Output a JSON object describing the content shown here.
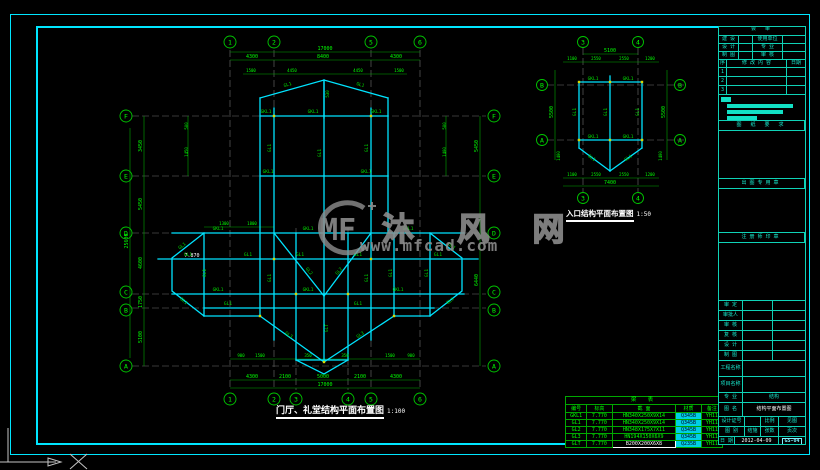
{
  "watermark": {
    "logo_text": "MF",
    "brand": "沐 风 网",
    "url": "www.mfcad.com"
  },
  "main_plan": {
    "title": "门厅、礼堂结构平面布置图",
    "scale": "1:100",
    "axes_top": [
      "1",
      "2",
      "5",
      "6"
    ],
    "axes_bottom": [
      "1",
      "2",
      "3",
      "4",
      "5",
      "6"
    ],
    "axes_left": [
      "F",
      "E",
      "D",
      "C",
      "B",
      "A"
    ],
    "axes_right": [
      "F",
      "E",
      "D",
      "C",
      "B",
      "A"
    ],
    "dim_total": "17000",
    "dims_top": [
      "4300",
      "8400",
      "4300"
    ],
    "dims_top_inner": [
      "1500",
      "4450",
      "4450",
      "1500"
    ],
    "dims_bottom": [
      "4300",
      "2100",
      "5000",
      "2100",
      "4300"
    ],
    "dims_bottom_small": [
      "900",
      "1500",
      "350",
      "350",
      "1500",
      "900"
    ],
    "dims_left": [
      "3450",
      "5450",
      "4600",
      "1750",
      "5100"
    ],
    "dim_left_total": "25600",
    "dims_right": [
      "5450",
      "6440"
    ],
    "dims_misc": [
      "500",
      "1450",
      "1400",
      "500",
      "1300",
      "1800"
    ],
    "level_label": "7.870",
    "ridge_dim": "530"
  },
  "entry_plan": {
    "title": "入口结构平面布置图",
    "scale": "1:50",
    "axes_top": [
      "3",
      "4"
    ],
    "axes_bottom": [
      "3",
      "4"
    ],
    "axes_left": [
      "B",
      "A"
    ],
    "axes_right": [
      "B",
      "A"
    ],
    "dim_top_total": "5100",
    "dims_top": [
      "1100",
      "2550",
      "2550",
      "1200"
    ],
    "dims_bottom": [
      "1100",
      "2550",
      "2550",
      "1200"
    ],
    "dim_bottom_total": "7400",
    "dims_side": [
      "5500",
      "5500"
    ],
    "dims_side_small": [
      "1400",
      "1400"
    ]
  },
  "beam_names": {
    "gkl1": "GKL1",
    "gl1": "GL1",
    "gl2": "GL2",
    "gl3": "GL3",
    "glt": "GLT"
  },
  "beam_table": {
    "title": "梁 表",
    "headers": [
      "编号",
      "标高",
      "截  面",
      "材质",
      "备注"
    ],
    "rows": [
      [
        "GKL1",
        "7.770",
        "HN340X250X9X14",
        "Q345B",
        "YH11"
      ],
      [
        "GL1",
        "7.770",
        "HN340X250X9X14",
        "Q345B",
        "YH11"
      ],
      [
        "GL2",
        "7.770",
        "HN348X175X7X11",
        "Q345B",
        "YH11"
      ],
      [
        "GL3",
        "7.770",
        "HN194X150X6X9",
        "Q345B",
        "YH11"
      ],
      [
        "GLT",
        "7.770",
        "B200X200X6X8",
        "Q235B",
        "YH11"
      ]
    ]
  },
  "titleblock": {
    "review_header": "会  审",
    "row1": [
      "建 设",
      "使用单位"
    ],
    "row2": [
      "设 计",
      "专 业"
    ],
    "row3": [
      "制 图",
      "审 核"
    ],
    "rev_cols": [
      "序",
      "修 改 内 容",
      "日期"
    ],
    "rev_rows": [
      "1",
      "2",
      "3"
    ],
    "sections": [
      "图 纸 要 求",
      "出图专用章",
      "注册师印章"
    ],
    "info_labels": [
      "审 定",
      "审批人",
      "审 核",
      "复 核",
      "设 计",
      "制 图"
    ],
    "project_labels": [
      "工程名称",
      "项目名称"
    ],
    "spec_label": "专 业",
    "spec_value": "结构",
    "name_label": "图 名",
    "name_value": "结构平面布置图",
    "meta_row1": [
      "设计证号",
      "",
      "比例",
      "见图"
    ],
    "meta_row2": [
      "图 别",
      "结施",
      "张数",
      "页次"
    ],
    "date_label": "日 期",
    "date_value": "2012-04-09",
    "sheet_no": "GS-04"
  }
}
